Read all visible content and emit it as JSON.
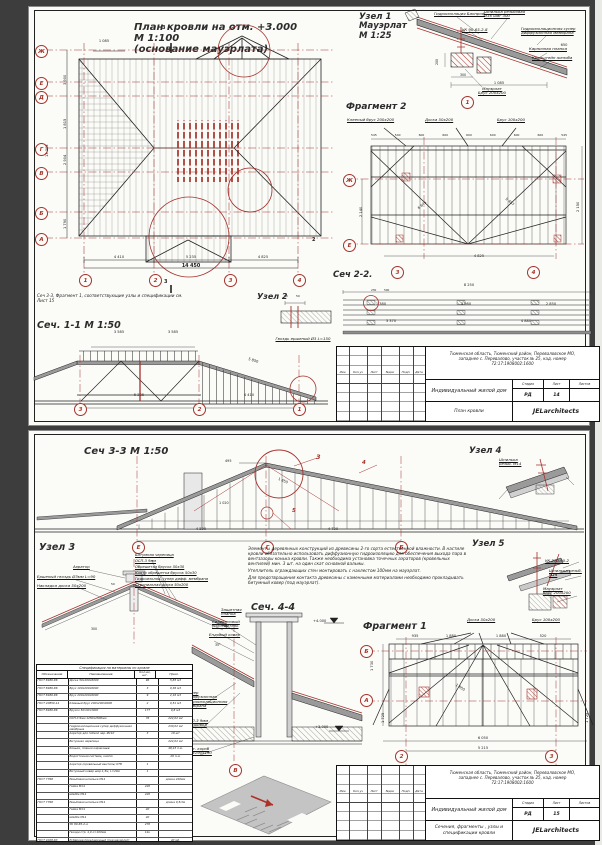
{
  "s1": {
    "plan": {
      "title": "План кровли на отм. +3.000\nМ 1:100\n(основание мауэрлата)",
      "note": "Сеч 3-3, Фрагмент 1, соответствующие узлы и спецификации см.\nЛист 15",
      "axes": [
        "Ж",
        "Е",
        "Д",
        "Г",
        "В",
        "Б",
        "А"
      ],
      "cols": [
        "1",
        "2",
        "3",
        "4"
      ],
      "dim_top": "1 085",
      "dims_bottom": [
        "4 410",
        "5 235",
        "4 825"
      ],
      "dim_total": "14 450",
      "dim_left_total": "13 305",
      "dims_left": [
        "3 900",
        "1 815",
        "2 904",
        "1 790"
      ],
      "cuts": {
        "a": "3",
        "b": "3",
        "c": "2"
      }
    },
    "node1": {
      "title": "Узел 1\nМауэрлат\nМ 1:25",
      "bubble": "1",
      "labels": {
        "l1": "Гидроизоляция Биопроф",
        "l2": "Шпилька резьбовая\nØ16 шаг 300",
        "l3": "УК 90-65-2-α",
        "l4": "Гидроизоляционная супер\nдиффузионная мембрана",
        "l5": "Карнизная планка",
        "l6": "Кронштейн желоба",
        "l7": "Мауэрлат\nБрус 200х200"
      },
      "dims": {
        "d1": "650",
        "d2": "1 085",
        "d3": "300",
        "d4": "200"
      }
    },
    "frag2": {
      "title": "Фрагмент 2",
      "labels": {
        "l1": "Клееный брус 200х200",
        "l2": "Доска 50х200",
        "l3": "Брус 100х200"
      },
      "axes": [
        "Ж",
        "Е"
      ],
      "dims_top": [
        "545",
        "540",
        "600",
        "600",
        "600",
        "600",
        "600",
        "600",
        "545"
      ],
      "dims": {
        "left": "2 140",
        "right": "2 150",
        "bottom": "4 825",
        "diag1": "6 645",
        "diag2": "5 497"
      }
    },
    "node2": {
      "title": "Узел 2",
      "label": "Гвоздь ершеный Ø3 L=150",
      "d1": "50",
      "d2": "50"
    },
    "sec11": {
      "title": "Сеч. 1-1 М 1:50",
      "bubbles": [
        "3",
        "2",
        "1"
      ],
      "dims": {
        "t1": "3 585",
        "t2": "3 585",
        "b1": "5 235",
        "b2": "4 410",
        "slope": "5 850"
      }
    },
    "sec22": {
      "title": "Сеч 2-2.",
      "bubbles": [
        "3",
        "4"
      ],
      "dims": {
        "top": "8 250",
        "m1": "230",
        "m2": "500",
        "a": "1 380",
        "b": "3 980",
        "c": "2 850",
        "s1": "3 370",
        "s2": "4 880"
      }
    },
    "tb": {
      "doc": "План кровли",
      "sheet": "14"
    }
  },
  "s2": {
    "sec33": {
      "title": "Сеч 3-3 М 1:50",
      "axes": [
        "Е",
        "Г",
        "Б"
      ],
      "calls": {
        "c3": "3",
        "c4": "4",
        "c5": "5"
      },
      "dims": {
        "b1": "4 520",
        "b2": "4 720",
        "d1": "495",
        "d2": "1 850",
        "d3": "1 020"
      }
    },
    "node4": {
      "title": "Узел 4",
      "label": "Шпилька\nрезьб. М14"
    },
    "node3": {
      "title": "Узел 3",
      "labels": {
        "l1": "Аэратор",
        "l2": "Ершеный гвоздь Ø3мм L=90",
        "l3": "Накладка доска 50х200"
      },
      "layers": [
        "Битумная черепица",
        "ОСП-3 9мм",
        "Обрешетка брусок 50х30",
        "Контр обрешетка брусок 50х30",
        "Гидроизоляц. супер дифф. мембрана",
        "Стропильная доска 50х200"
      ],
      "dims": {
        "d1": "50",
        "d2": "300"
      }
    },
    "notes": [
      "Элементы деревянных конструкций из древесины 2-го сорта естественной влажности. В настиле кровли обязательно использовать диффузионную гидроизоляцию для обеспечения выхода пара в вентзазоры конька кровли. Также необходима установка точечных аэраторов (кровельных вентилей) мин. 3 шт. на один скат основной вальмы.",
      "Утеплитель ограждающих стен монтировать с нахлестом 100мм на мауэрлат.",
      "Для предотвращения контакта древесины с каменными материалами необходимо прокладывать битумный ковер (под мауэрлат)."
    ],
    "sec44": {
      "title": "Сеч. 4-4",
      "axis": "В",
      "marks": {
        "top": "+4.000",
        "bottom": "+3.000",
        "angle": "35°"
      },
      "labels": {
        "l1": "Защитная\nпланка",
        "l2": "Силиконовый\nуплотнитель",
        "l3": "Ендовый ковер",
        "l4": "Супер\nдиффузионная\nгидроизоляционная\nмембрана",
        "l5": "ОСП-3 9мм\nподшивка",
        "l6": "Вент. короб\n390х190х190"
      }
    },
    "node5": {
      "title": "Узел 5",
      "labels": {
        "l1": "УК 270-90-2",
        "l2": "Шпилька резьб.\nМ14",
        "l3": "Мауэрлат\nбрус 200х200"
      }
    },
    "frag1": {
      "title": "Фрагмент 1",
      "axes": [
        "Б",
        "А"
      ],
      "cols": [
        "2",
        "3"
      ],
      "labels": {
        "l1": "Доска 50х200",
        "l2": "Брус 100х200"
      },
      "dims": {
        "t1": "935",
        "t2": "1 880",
        "t3": "1 880",
        "t4": "520",
        "left": "1 730",
        "sl": "1 725",
        "sr": "1 725",
        "b1": "6 050",
        "b2": "5 215",
        "diag": "1 850"
      }
    },
    "spec": {
      "title": "Спецификация на материалы по кровле",
      "headers": [
        "Обозначение",
        "Наименование",
        "Кол-во,\nшт.",
        "Прим."
      ],
      "rows": [
        [
          "ГОСТ 8486-86",
          "Доска 50х200х6000",
          "96",
          "5,83 м3"
        ],
        [
          "ГОСТ 8486-86",
          "Брус 100х200х6000",
          "3",
          "0,36 м3"
        ],
        [
          "ГОСТ 8486-86",
          "Брус 200х200х6000",
          "9",
          "2,16 м3"
        ],
        [
          "ГОСТ 20850-14",
          "Клееный брус 200х200х6000",
          "2",
          "0,51 м3"
        ],
        [
          "ГОСТ 8486-86",
          "Брусок 50х30х3000",
          "177",
          "0,8 м3"
        ],
        [
          "",
          "ОСП-3 9мм 1250х2500мм",
          "76",
          "222,02 м2"
        ],
        [
          "",
          "Гидроизоляционная супер диффузионная мембрана",
          "",
          "230,02 м2"
        ],
        [
          "",
          "Аэратор для гибкой чер. Ø110",
          "3",
          "16 шт"
        ],
        [
          "",
          "Битумная черепица",
          "",
          "222,02 м2"
        ],
        [
          "",
          "Коньки, планки карнизные",
          "",
          "48,43 п.м."
        ],
        [
          "",
          "Водосточная система, компл.",
          "",
          "26 п.м."
        ],
        [
          "",
          "Аэратор (кровельный вентиль) КТВ",
          "1",
          ""
        ],
        [
          "",
          "Битумный ковер шир.1,5м, L=20м",
          "1",
          ""
        ],
        [
          "ГОСТ 7798",
          "Резьбовая шпилька М14",
          "",
          "длина 220мм"
        ],
        [
          "",
          "Гайка М14",
          "220",
          ""
        ],
        [
          "",
          "Шайба М14",
          "220",
          ""
        ],
        [
          "ГОСТ 7798",
          "Резьбовая шпилька М14",
          "",
          "длина 0,5/1м"
        ],
        [
          "",
          "Гайка М14",
          "40",
          ""
        ],
        [
          "",
          "Шайба М14",
          "40",
          ""
        ],
        [
          "",
          "УК 90-65-2-α",
          "270",
          ""
        ],
        [
          "",
          "Гвозди стр. 4,0 L=100мм",
          "14к",
          ""
        ],
        [
          "ГОСТ 4028-63",
          "Рубероид прокладочный (под мауэрлат)",
          "",
          "40 м2,\nкомпл. 40 м"
        ],
        [
          "",
          "Гвоздь ершеный Ø3,5 L=90мм",
          "",
          "6 м"
        ]
      ]
    },
    "tb": {
      "doc": "Сечения, фрагменты , узлы и\nспецификации кровли",
      "sheet": "15"
    }
  },
  "tb": {
    "rev": [
      "Изм.",
      "Кол.уч",
      "Лист",
      "№док",
      "Подп.",
      "Дата"
    ],
    "project": "Тюменская область, Тюменский район, Переваловское МО,\nзападнее с. Перевалово, участок № 25, кад. номер\n72:17:1908002:1600",
    "object": "Индивидуальный жилой дом",
    "stage_h": [
      "Стадия",
      "Лист",
      "Листов"
    ],
    "stage": "РД",
    "firm": "JELarchitects"
  }
}
